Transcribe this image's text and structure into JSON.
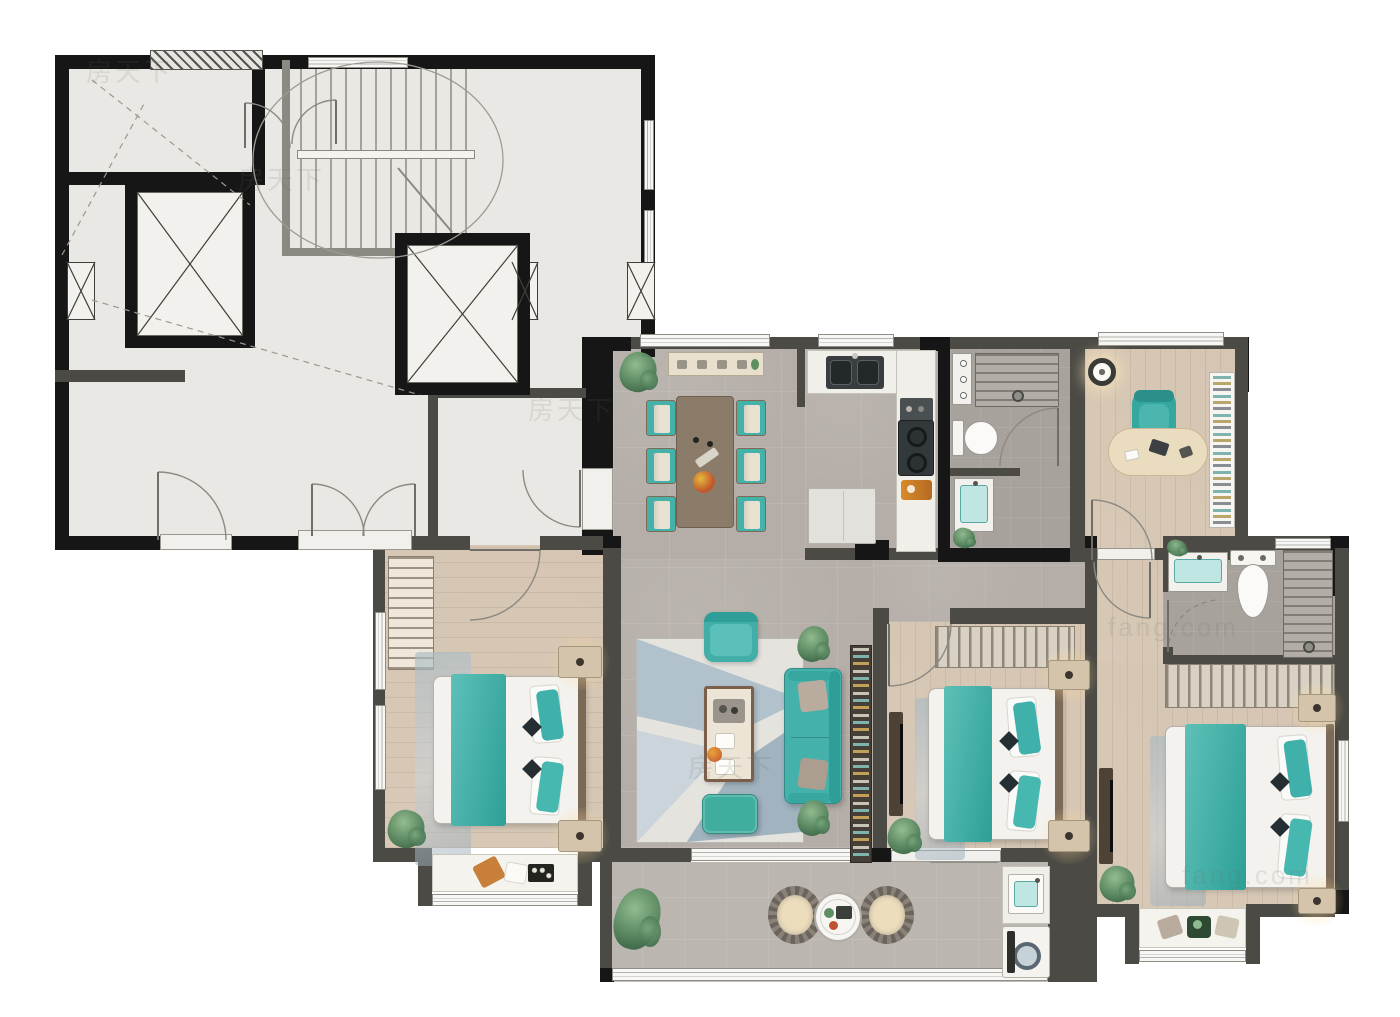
{
  "title": "apartment-floor-plan",
  "watermarks": [
    {
      "t": "房天下",
      "x": 86,
      "y": 52
    },
    {
      "t": "房天下",
      "x": 238,
      "y": 160
    },
    {
      "t": "房天下",
      "x": 528,
      "y": 390
    },
    {
      "t": "房天下",
      "x": 688,
      "y": 748
    },
    {
      "t": "fang.com",
      "x": 1108,
      "y": 612
    },
    {
      "t": "fang.com",
      "x": 1182,
      "y": 860
    }
  ],
  "palette": {
    "black": "#161616",
    "dark": "#4b4a45",
    "mid": "#8a8a82",
    "lobby": "#e9e8e4",
    "tile": "#b5aea8",
    "wood": "#d5c5b2",
    "bath": "#a8a29d",
    "balc": "#bcb6b0",
    "teal": "#45b1ab",
    "tealDeep": "#2f9e98",
    "white": "#f3f2ee",
    "counter": "#f0efe9",
    "brown": "#8b7b69",
    "beige": "#e7ddc6",
    "line": "#8b8a82"
  },
  "floors": [
    {
      "x": 55,
      "y": 55,
      "w": 600,
      "h": 290,
      "f": "lobby",
      "n": "lobby-floor-upper"
    },
    {
      "x": 55,
      "y": 345,
      "w": 527,
      "h": 205,
      "f": "lobby",
      "n": "lobby-floor-lower"
    },
    {
      "x": 613,
      "y": 345,
      "w": 192,
      "h": 215,
      "f": "tile",
      "n": "dining-floor"
    },
    {
      "x": 805,
      "y": 345,
      "w": 133,
      "h": 215,
      "f": "tile",
      "n": "kitchen-floor"
    },
    {
      "x": 950,
      "y": 345,
      "w": 120,
      "h": 203,
      "f": "bath",
      "n": "bathroom1-floor"
    },
    {
      "x": 1085,
      "y": 345,
      "w": 150,
      "h": 203,
      "f": "wood",
      "g": 0,
      "n": "study-floor"
    },
    {
      "x": 613,
      "y": 560,
      "w": 260,
      "h": 288,
      "f": "tile",
      "n": "living-floor"
    },
    {
      "x": 873,
      "y": 560,
      "w": 212,
      "h": 62,
      "f": "tile",
      "n": "corridor-floor"
    },
    {
      "x": 385,
      "y": 545,
      "w": 228,
      "h": 303,
      "f": "wood",
      "g": 90,
      "n": "bedroom-left-floor"
    },
    {
      "x": 885,
      "y": 622,
      "w": 210,
      "h": 226,
      "f": "wood",
      "g": 0,
      "n": "bedroom-middle-floor"
    },
    {
      "x": 1097,
      "y": 548,
      "w": 66,
      "h": 114,
      "f": "wood",
      "g": 0,
      "n": "master-hall-floor"
    },
    {
      "x": 1163,
      "y": 548,
      "w": 172,
      "h": 114,
      "f": "bath",
      "n": "bathroom2-floor"
    },
    {
      "x": 1097,
      "y": 662,
      "w": 238,
      "h": 248,
      "f": "wood",
      "g": 0,
      "n": "master-bedroom-floor"
    },
    {
      "x": 600,
      "y": 862,
      "w": 455,
      "h": 120,
      "f": "balc",
      "n": "balcony-floor"
    }
  ],
  "walls": [
    [
      55,
      55,
      600,
      14,
      "black"
    ],
    [
      55,
      55,
      14,
      495,
      "black"
    ],
    [
      641,
      55,
      14,
      302,
      "black"
    ],
    [
      55,
      536,
      330,
      14,
      "black"
    ],
    [
      582,
      337,
      31,
      218,
      "black"
    ],
    [
      55,
      172,
      210,
      13,
      "black"
    ],
    [
      252,
      55,
      13,
      130,
      "black"
    ],
    [
      55,
      370,
      130,
      12,
      "dark"
    ],
    [
      428,
      388,
      10,
      158,
      "dark"
    ],
    [
      428,
      388,
      158,
      10,
      "dark"
    ],
    [
      282,
      60,
      8,
      196,
      "mid"
    ],
    [
      282,
      248,
      200,
      8,
      "mid"
    ],
    [
      385,
      536,
      85,
      14,
      "dark"
    ],
    [
      540,
      536,
      73,
      14,
      "dark"
    ],
    [
      613,
      337,
      325,
      12,
      "dark"
    ],
    [
      613,
      337,
      18,
      14,
      "black"
    ],
    [
      920,
      337,
      30,
      14,
      "black"
    ],
    [
      938,
      337,
      12,
      223,
      "black"
    ],
    [
      950,
      337,
      120,
      12,
      "dark"
    ],
    [
      1070,
      337,
      15,
      223,
      "dark"
    ],
    [
      1085,
      337,
      163,
      12,
      "dark"
    ],
    [
      1235,
      337,
      14,
      55,
      "black"
    ],
    [
      1235,
      337,
      13,
      223,
      "dark"
    ],
    [
      797,
      345,
      8,
      62,
      "dark"
    ],
    [
      805,
      548,
      133,
      12,
      "dark"
    ],
    [
      938,
      548,
      132,
      14,
      "black"
    ],
    [
      1070,
      548,
      27,
      14,
      "dark"
    ],
    [
      1155,
      548,
      80,
      12,
      "dark"
    ],
    [
      950,
      468,
      70,
      8,
      "dark"
    ],
    [
      873,
      608,
      16,
      16,
      "dark"
    ],
    [
      950,
      608,
      147,
      16,
      "dark"
    ],
    [
      873,
      624,
      14,
      224,
      "dark"
    ],
    [
      1085,
      548,
      12,
      362,
      "dark"
    ],
    [
      1085,
      536,
      12,
      12,
      "black"
    ],
    [
      855,
      540,
      34,
      20,
      "black"
    ],
    [
      1163,
      536,
      186,
      14,
      "dark"
    ],
    [
      1330,
      536,
      19,
      60,
      "black"
    ],
    [
      1163,
      548,
      10,
      44,
      "dark"
    ],
    [
      1163,
      647,
      10,
      15,
      "dark"
    ],
    [
      1163,
      655,
      186,
      9,
      "dark"
    ],
    [
      1335,
      548,
      14,
      362,
      "dark"
    ],
    [
      1335,
      890,
      14,
      24,
      "black"
    ],
    [
      603,
      545,
      18,
      303,
      "dark"
    ],
    [
      603,
      536,
      18,
      12,
      "black"
    ],
    [
      373,
      536,
      12,
      319,
      "dark"
    ],
    [
      373,
      848,
      58,
      14,
      "dark"
    ],
    [
      585,
      848,
      28,
      14,
      "dark"
    ],
    [
      418,
      848,
      14,
      58,
      "dark"
    ],
    [
      578,
      848,
      14,
      58,
      "dark"
    ],
    [
      611,
      848,
      80,
      14,
      "dark"
    ],
    [
      871,
      848,
      20,
      14,
      "black"
    ],
    [
      1001,
      848,
      50,
      14,
      "dark"
    ],
    [
      1048,
      848,
      49,
      134,
      "dark"
    ],
    [
      600,
      848,
      12,
      134,
      "dark"
    ],
    [
      600,
      968,
      14,
      14,
      "black"
    ],
    [
      1097,
      904,
      40,
      13,
      "dark"
    ],
    [
      1255,
      904,
      80,
      13,
      "dark"
    ],
    [
      1125,
      904,
      14,
      60,
      "dark"
    ],
    [
      1246,
      904,
      14,
      60,
      "dark"
    ]
  ],
  "windows": [
    [
      640,
      334,
      130,
      13,
      "h"
    ],
    [
      818,
      334,
      76,
      13,
      "h"
    ],
    [
      1098,
      332,
      126,
      14,
      "h"
    ],
    [
      1275,
      538,
      56,
      11,
      "h"
    ],
    [
      1338,
      740,
      11,
      82,
      "v"
    ],
    [
      432,
      894,
      146,
      12,
      "h"
    ],
    [
      930,
      850,
      68,
      13,
      "h"
    ],
    [
      1139,
      950,
      107,
      12,
      "h"
    ],
    [
      691,
      848,
      180,
      13,
      "h"
    ],
    [
      375,
      612,
      11,
      78,
      "v"
    ],
    [
      375,
      705,
      11,
      85,
      "v"
    ],
    [
      308,
      57,
      100,
      11,
      "h"
    ],
    [
      612,
      968,
      436,
      13,
      "h"
    ],
    [
      644,
      120,
      10,
      70,
      "v"
    ],
    [
      644,
      210,
      10,
      60,
      "v"
    ]
  ],
  "thresholds": [
    [
      160,
      534,
      72,
      16
    ],
    [
      298,
      530,
      114,
      20
    ],
    [
      582,
      468,
      31,
      62
    ],
    [
      1097,
      548,
      58,
      12
    ],
    [
      891,
      850,
      110,
      12
    ],
    [
      425,
      250,
      72,
      12
    ],
    [
      160,
      336,
      62,
      12
    ],
    [
      428,
      233,
      70,
      12
    ]
  ],
  "hatches": [
    [
      150,
      50,
      113,
      20
    ]
  ],
  "shafts": [
    [
      67,
      262,
      28,
      58
    ],
    [
      512,
      262,
      26,
      58
    ],
    [
      627,
      262,
      28,
      58
    ]
  ],
  "elevators": [
    [
      125,
      180,
      130,
      168
    ],
    [
      395,
      233,
      135,
      162
    ]
  ],
  "stairs": {
    "zone": [
      300,
      62,
      170,
      188
    ],
    "rail": [
      297,
      150,
      178,
      9
    ],
    "ellipse": [
      378,
      160,
      125,
      98
    ],
    "diag": [
      398,
      168,
      452,
      232
    ]
  },
  "dashlines": [
    [
      92,
      80,
      250,
      205
    ],
    [
      62,
      255,
      145,
      102
    ],
    [
      92,
      300,
      420,
      395
    ]
  ],
  "arcs": [
    {
      "d": "M158 472 A68 68 0 0 1 226 540",
      "leaf": [
        158,
        472,
        158,
        540
      ]
    },
    {
      "d": "M312 484 A52 52 0 0 1 364 536",
      "leaf": [
        312,
        536,
        312,
        484
      ]
    },
    {
      "d": "M415 484 A52 52 0 0 0 363 536",
      "leaf": [
        415,
        536,
        415,
        484
      ]
    },
    {
      "d": "M580 527 A57 57 0 0 1 523 470",
      "leaf": [
        580,
        470,
        580,
        527
      ]
    },
    {
      "d": "M245 103 A45 45 0 0 1 290 148",
      "leaf": [
        245,
        148,
        245,
        103
      ]
    },
    {
      "d": "M336 100 A44 44 0 0 0 292 144",
      "leaf": [
        336,
        144,
        336,
        100
      ]
    },
    {
      "d": "M540 550 A70 70 0 0 1 470 620",
      "leaf": [
        470,
        550,
        540,
        550
      ]
    },
    {
      "d": "M1058 408 A58 58 0 0 0 1000 466",
      "leaf": [
        1058,
        466,
        1058,
        408
      ]
    },
    {
      "d": "M1092 500 A60 60 0 0 1 1152 560",
      "leaf": [
        1092,
        560,
        1092,
        500
      ]
    },
    {
      "d": "M889 686 A62 62 0 0 0 951 624",
      "leaf": [
        889,
        624,
        889,
        686
      ]
    },
    {
      "d": "M1150 618 A56 56 0 0 1 1094 562",
      "leaf": [
        1150,
        562,
        1150,
        618
      ]
    },
    {
      "d": "M1168 652 A52 52 0 0 1 1220 600",
      "leaf": [
        1168,
        600,
        1168,
        652
      ],
      "dash": true
    }
  ],
  "furniture": [
    {
      "t": "plant",
      "x": 620,
      "y": 352,
      "w": 36,
      "h": 40,
      "n": "dining-plant"
    },
    {
      "t": "sideboard",
      "x": 668,
      "y": 352,
      "w": 96,
      "h": 24,
      "n": "dining-sideboard"
    },
    {
      "t": "dtable",
      "x": 676,
      "y": 396,
      "w": 58,
      "h": 132,
      "n": "dining-table"
    },
    {
      "t": "dchair",
      "x": 646,
      "y": 400,
      "w": 30,
      "h": 36,
      "n": "dining-chair"
    },
    {
      "t": "dchair",
      "x": 646,
      "y": 448,
      "w": 30,
      "h": 36,
      "n": "dining-chair"
    },
    {
      "t": "dchair",
      "x": 646,
      "y": 496,
      "w": 30,
      "h": 36,
      "n": "dining-chair"
    },
    {
      "t": "dchair",
      "x": 736,
      "y": 400,
      "w": 30,
      "h": 36,
      "n": "dining-chair"
    },
    {
      "t": "dchair",
      "x": 736,
      "y": 448,
      "w": 30,
      "h": 36,
      "n": "dining-chair"
    },
    {
      "t": "dchair",
      "x": 736,
      "y": 496,
      "w": 30,
      "h": 36,
      "n": "dining-chair"
    },
    {
      "t": "counter",
      "x": 807,
      "y": 350,
      "w": 128,
      "h": 44,
      "n": "kitchen-counter-top"
    },
    {
      "t": "counter",
      "x": 896,
      "y": 350,
      "w": 40,
      "h": 202,
      "n": "kitchen-counter-right"
    },
    {
      "t": "sink2",
      "x": 826,
      "y": 356,
      "w": 58,
      "h": 33,
      "n": "kitchen-sink"
    },
    {
      "t": "smallApp",
      "x": 900,
      "y": 398,
      "w": 33,
      "h": 26,
      "n": "kitchen-appliance"
    },
    {
      "t": "stove",
      "x": 898,
      "y": 420,
      "w": 36,
      "h": 56,
      "n": "kitchen-stove"
    },
    {
      "t": "board",
      "x": 901,
      "y": 480,
      "w": 31,
      "h": 20,
      "n": "kitchen-cutting-board"
    },
    {
      "t": "fridge",
      "x": 808,
      "y": 488,
      "w": 68,
      "h": 56,
      "n": "kitchen-fridge"
    },
    {
      "t": "towel",
      "x": 952,
      "y": 353,
      "w": 20,
      "h": 52,
      "n": "bath1-shelf"
    },
    {
      "t": "shower",
      "x": 975,
      "y": 353,
      "w": 84,
      "h": 54,
      "n": "bath1-shower"
    },
    {
      "t": "toiletR",
      "x": 952,
      "y": 418,
      "w": 48,
      "h": 40,
      "n": "bath1-toilet"
    },
    {
      "t": "vanity",
      "x": 954,
      "y": 478,
      "w": 40,
      "h": 54,
      "n": "bath1-vanity"
    },
    {
      "t": "plant",
      "x": 953,
      "y": 528,
      "w": 22,
      "h": 20,
      "n": "bath1-plant"
    },
    {
      "t": "pendant",
      "x": 1088,
      "y": 358,
      "w": 28,
      "h": 28,
      "n": "study-pendant-lamp"
    },
    {
      "t": "ochair",
      "x": 1132,
      "y": 390,
      "w": 44,
      "h": 48,
      "n": "study-chair"
    },
    {
      "t": "desk",
      "x": 1108,
      "y": 428,
      "w": 100,
      "h": 48,
      "n": "study-desk"
    },
    {
      "t": "bookshelfV",
      "x": 1209,
      "y": 372,
      "w": 26,
      "h": 156,
      "n": "study-bookshelf"
    },
    {
      "t": "wardrobeH",
      "x": 388,
      "y": 556,
      "w": 46,
      "h": 114,
      "n": "bedroom-left-wardrobe"
    },
    {
      "t": "rugB",
      "x": 415,
      "y": 652,
      "w": 56,
      "h": 214,
      "n": "bedroom-left-rug"
    },
    {
      "t": "bed",
      "x": 433,
      "y": 676,
      "w": 152,
      "h": 148,
      "n": "bedroom-left-bed"
    },
    {
      "t": "nightstand",
      "x": 558,
      "y": 646,
      "w": 44,
      "h": 32,
      "n": "nightstand"
    },
    {
      "t": "nightstand",
      "x": 558,
      "y": 820,
      "w": 44,
      "h": 32,
      "n": "nightstand"
    },
    {
      "t": "plant",
      "x": 388,
      "y": 810,
      "w": 36,
      "h": 38,
      "n": "bedroom-left-plant"
    },
    {
      "t": "bench",
      "x": 432,
      "y": 854,
      "w": 146,
      "h": 38,
      "n": "bedroom-left-bay-seat"
    },
    {
      "t": "lrug",
      "x": 636,
      "y": 638,
      "w": 168,
      "h": 205,
      "n": "living-rug"
    },
    {
      "t": "armchair",
      "x": 704,
      "y": 612,
      "w": 54,
      "h": 50,
      "n": "living-armchair"
    },
    {
      "t": "ctable",
      "x": 704,
      "y": 686,
      "w": 50,
      "h": 96,
      "n": "living-coffee-table"
    },
    {
      "t": "sofa",
      "x": 784,
      "y": 668,
      "w": 58,
      "h": 136,
      "n": "living-sofa"
    },
    {
      "t": "ottoman",
      "x": 702,
      "y": 794,
      "w": 56,
      "h": 40,
      "n": "living-ottoman"
    },
    {
      "t": "plant",
      "x": 798,
      "y": 626,
      "w": 30,
      "h": 36,
      "n": "living-plant"
    },
    {
      "t": "plant",
      "x": 798,
      "y": 800,
      "w": 30,
      "h": 36,
      "n": "living-plant"
    },
    {
      "t": "bookshelfTall",
      "x": 850,
      "y": 645,
      "w": 22,
      "h": 218,
      "n": "living-bookshelf"
    },
    {
      "t": "tvBoard",
      "x": 889,
      "y": 712,
      "w": 14,
      "h": 104,
      "n": "bedroom-middle-tv"
    },
    {
      "t": "wardrobeHang",
      "x": 935,
      "y": 626,
      "w": 140,
      "h": 42,
      "n": "bedroom-middle-wardrobe"
    },
    {
      "t": "rugB",
      "x": 915,
      "y": 698,
      "w": 50,
      "h": 162,
      "n": "bedroom-middle-rug"
    },
    {
      "t": "bed",
      "x": 928,
      "y": 688,
      "w": 134,
      "h": 152,
      "n": "bedroom-middle-bed"
    },
    {
      "t": "nightstand",
      "x": 1048,
      "y": 660,
      "w": 42,
      "h": 30,
      "n": "nightstand"
    },
    {
      "t": "nightstand",
      "x": 1048,
      "y": 820,
      "w": 42,
      "h": 32,
      "n": "nightstand"
    },
    {
      "t": "plant",
      "x": 888,
      "y": 818,
      "w": 32,
      "h": 36,
      "n": "bedroom-middle-plant"
    },
    {
      "t": "vanity",
      "x": 1168,
      "y": 552,
      "w": 60,
      "h": 40,
      "n": "bath2-vanity"
    },
    {
      "t": "plant",
      "x": 1167,
      "y": 540,
      "w": 20,
      "h": 16,
      "n": "bath2-plant"
    },
    {
      "t": "toiletD",
      "x": 1228,
      "y": 550,
      "w": 50,
      "h": 70,
      "n": "bath2-toilet"
    },
    {
      "t": "shower",
      "x": 1283,
      "y": 550,
      "w": 50,
      "h": 108,
      "n": "bath2-shower"
    },
    {
      "t": "wardrobeHang",
      "x": 1165,
      "y": 664,
      "w": 170,
      "h": 44,
      "n": "master-wardrobe"
    },
    {
      "t": "rugB",
      "x": 1150,
      "y": 736,
      "w": 56,
      "h": 170,
      "n": "master-rug"
    },
    {
      "t": "bed",
      "x": 1165,
      "y": 726,
      "w": 168,
      "h": 162,
      "n": "master-bed"
    },
    {
      "t": "nightstand",
      "x": 1298,
      "y": 694,
      "w": 38,
      "h": 28,
      "n": "nightstand"
    },
    {
      "t": "nightstand",
      "x": 1298,
      "y": 888,
      "w": 38,
      "h": 26,
      "n": "nightstand"
    },
    {
      "t": "plant",
      "x": 1100,
      "y": 866,
      "w": 34,
      "h": 36,
      "n": "master-plant"
    },
    {
      "t": "tvBoard",
      "x": 1099,
      "y": 768,
      "w": 14,
      "h": 96,
      "n": "master-tv"
    },
    {
      "t": "bench",
      "x": 1139,
      "y": 908,
      "w": 107,
      "h": 40,
      "v": 2,
      "n": "master-bay-seat"
    },
    {
      "t": "plant",
      "x": 615,
      "y": 888,
      "w": 44,
      "h": 62,
      "n": "balcony-plant"
    },
    {
      "t": "rchair",
      "x": 768,
      "y": 886,
      "w": 54,
      "h": 58,
      "n": "balcony-chair"
    },
    {
      "t": "rchair",
      "x": 860,
      "y": 886,
      "w": 54,
      "h": 58,
      "n": "balcony-chair"
    },
    {
      "t": "rtable",
      "x": 814,
      "y": 892,
      "w": 48,
      "h": 50,
      "n": "balcony-table"
    },
    {
      "t": "counter",
      "x": 1002,
      "y": 866,
      "w": 48,
      "h": 58,
      "n": "laundry-counter"
    },
    {
      "t": "lsink",
      "x": 1008,
      "y": 874,
      "w": 36,
      "h": 40,
      "n": "laundry-sink"
    },
    {
      "t": "washer",
      "x": 1002,
      "y": 926,
      "w": 48,
      "h": 52,
      "n": "washing-machine"
    }
  ]
}
